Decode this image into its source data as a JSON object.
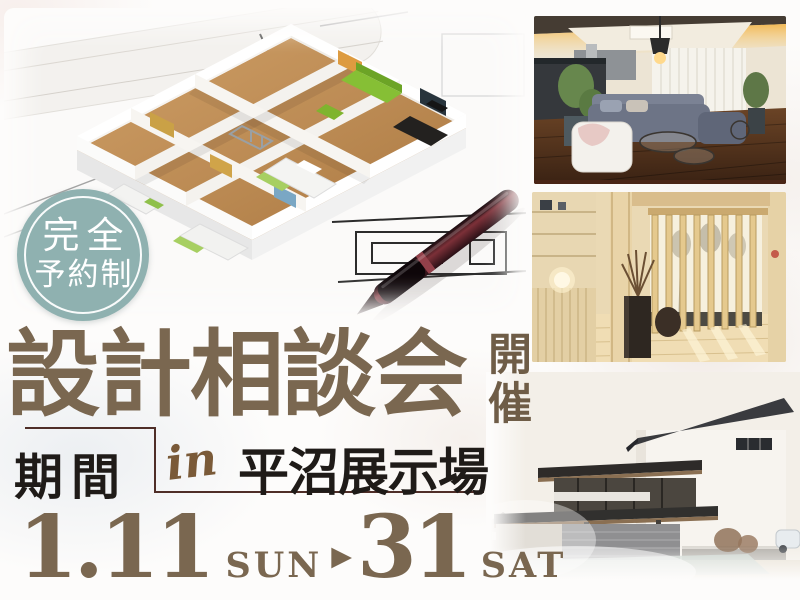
{
  "badge": {
    "line1": "完全",
    "line2": "予約制"
  },
  "title": {
    "main": "設計相談会",
    "held": "開催"
  },
  "venue": {
    "period_label": "期間",
    "in_word": "in",
    "location": "平沼展示場"
  },
  "schedule": {
    "start_date": "1.11",
    "start_day": "SUN",
    "arrow": "▶",
    "end_date": "31",
    "end_day": "SAT"
  },
  "colors": {
    "badge_teal": "#8fb1b0",
    "headline_brown": "#7a6750",
    "date_brown": "#7a6750",
    "divider_maroon": "#4f2e28",
    "ink_black": "#1f1b18",
    "script_brown": "#7a5a38"
  },
  "images": {
    "floorplan": "3d-floorplan-model-on-blueprint-with-pen",
    "living": "modern-living-room-interior",
    "entrance": "wooden-japanese-entrance-interior",
    "exterior": "model-house-exterior"
  }
}
